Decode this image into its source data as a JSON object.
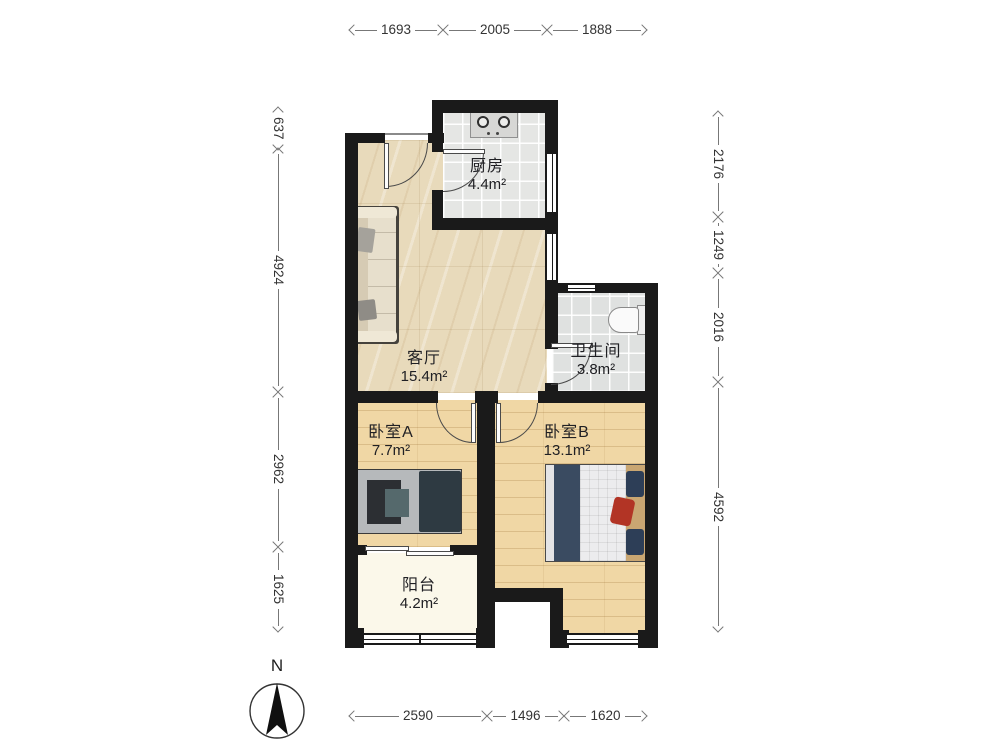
{
  "plan": {
    "rooms": [
      {
        "name": "厨房",
        "area": "4.4m²"
      },
      {
        "name": "客厅",
        "area": "15.4m²"
      },
      {
        "name": "卫生间",
        "area": "3.8m²"
      },
      {
        "name": "卧室A",
        "area": "7.7m²"
      },
      {
        "name": "卧室B",
        "area": "13.1m²"
      },
      {
        "name": "阳台",
        "area": "4.2m²"
      }
    ],
    "furniture": [
      "sofa",
      "stove-two-burner",
      "toilet",
      "single-bed",
      "double-bed",
      "sliding-door"
    ]
  },
  "dimensions_mm": {
    "top": [
      "1693",
      "2005",
      "1888"
    ],
    "bottom": [
      "2590",
      "1496",
      "1620"
    ],
    "left": [
      "637",
      "4924",
      "2962",
      "1625"
    ],
    "right": [
      "2176",
      "1249",
      "2016",
      "4592"
    ]
  },
  "compass": {
    "label": "N"
  },
  "colors": {
    "wall": "#1a1a1a",
    "marble_floor": "#e8dabb",
    "wood_floor": "#f0d7a5",
    "tile_floor": "#e5e6e4",
    "balcony_floor": "#fbf8ea",
    "bed_blanket_navy": "#2e3a42",
    "bed_quilt_white": "#ececee",
    "red_cushion": "#b23425",
    "dim_text": "#333333"
  }
}
